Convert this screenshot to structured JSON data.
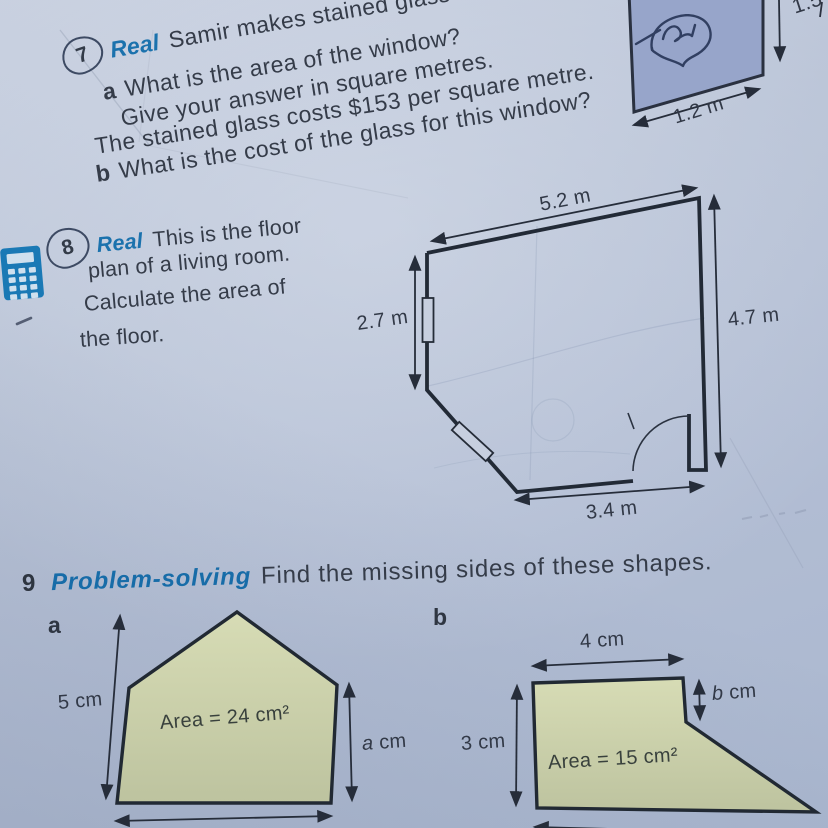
{
  "q7": {
    "number": "7",
    "tag": "Real",
    "intro": "Samir makes stained glass window",
    "part_a_label": "a",
    "part_a_text": "What is the area of the window?",
    "line_give": "Give your answer in square metres.",
    "line_cost": "The stained glass costs $153 per square metre.",
    "part_b_label": "b",
    "part_b_text": "What is the cost of the glass for this window?",
    "window": {
      "width_label": "1.2 m",
      "height_label": "1.5"
    }
  },
  "q8": {
    "number": "8",
    "tag": "Real",
    "line1": "This is the floor",
    "line2": "plan of a living room.",
    "line3": "Calculate the area of",
    "line4": "the floor.",
    "floorplan": {
      "top_label": "5.2 m",
      "left_label": "2.7 m",
      "right_label": "4.7 m",
      "bottom_label": "3.4 m"
    }
  },
  "q9": {
    "number": "9",
    "tag": "Problem-solving",
    "text": "Find the missing sides of these shapes.",
    "shape_a": {
      "label": "a",
      "left_label": "5 cm",
      "right_var": "a",
      "right_unit": " cm",
      "area_label": "Area = 24 cm²"
    },
    "shape_b": {
      "label": "b",
      "top_label": "4 cm",
      "right_var": "b",
      "right_unit": " cm",
      "left_label": "3 cm",
      "area_label": "Area = 15 cm²"
    }
  },
  "colors": {
    "accent_blue": "#1b72ad",
    "ink": "#353c49",
    "window_fill": "#97a5ca",
    "shape_fill": "#cdd3ac",
    "pen_ink": "#2c3a5c",
    "calculator_blue": "#1a79b5"
  }
}
